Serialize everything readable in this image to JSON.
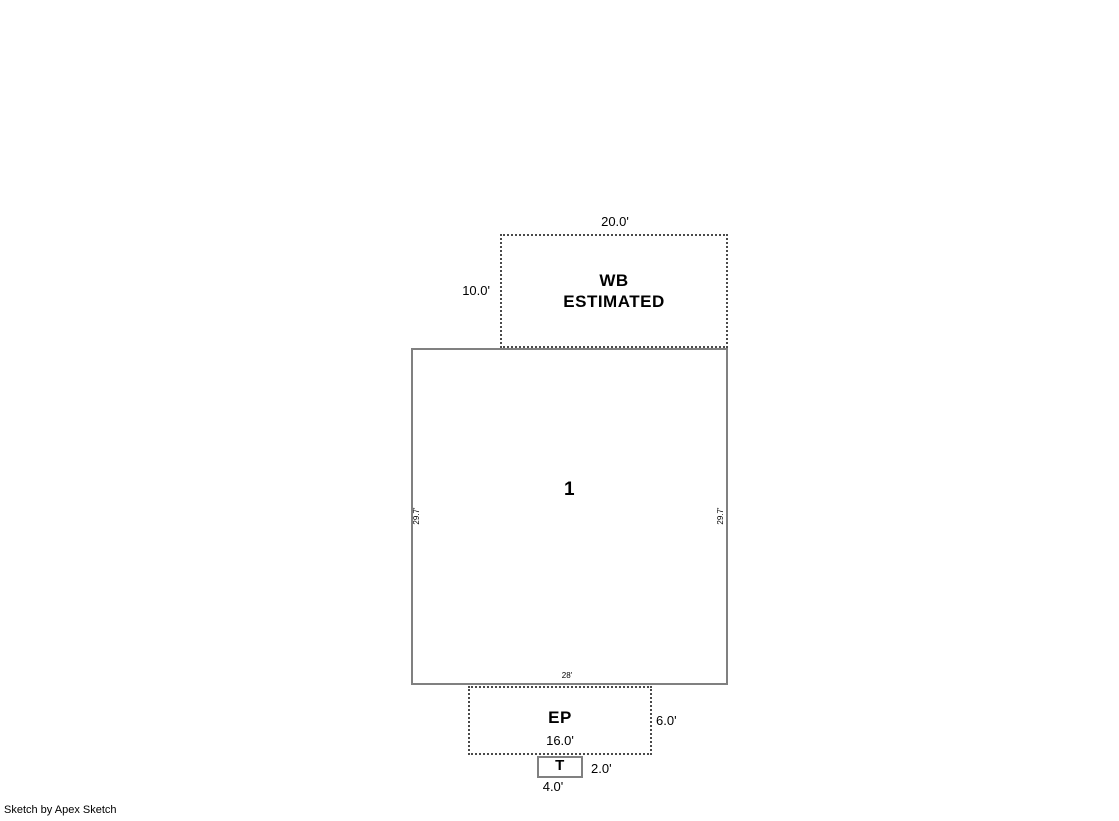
{
  "credit": "Sketch by Apex Sketch",
  "colors": {
    "background": "#ffffff",
    "solid_line": "#808080",
    "dashed_line": "#4a4a4a",
    "text": "#000000"
  },
  "areas": {
    "wb": {
      "name": "WB",
      "qualifier": "ESTIMATED",
      "dims": {
        "top": "20.0'",
        "left": "10.0'"
      }
    },
    "main": {
      "name": "1",
      "dims": {
        "left": "29.7'",
        "right": "29.7'",
        "bottom": "28'"
      }
    },
    "ep": {
      "name": "EP",
      "dims": {
        "width": "16.0'",
        "right": "6.0'"
      }
    },
    "t": {
      "name": "T",
      "dims": {
        "right": "2.0'",
        "bottom": "4.0'"
      }
    }
  }
}
